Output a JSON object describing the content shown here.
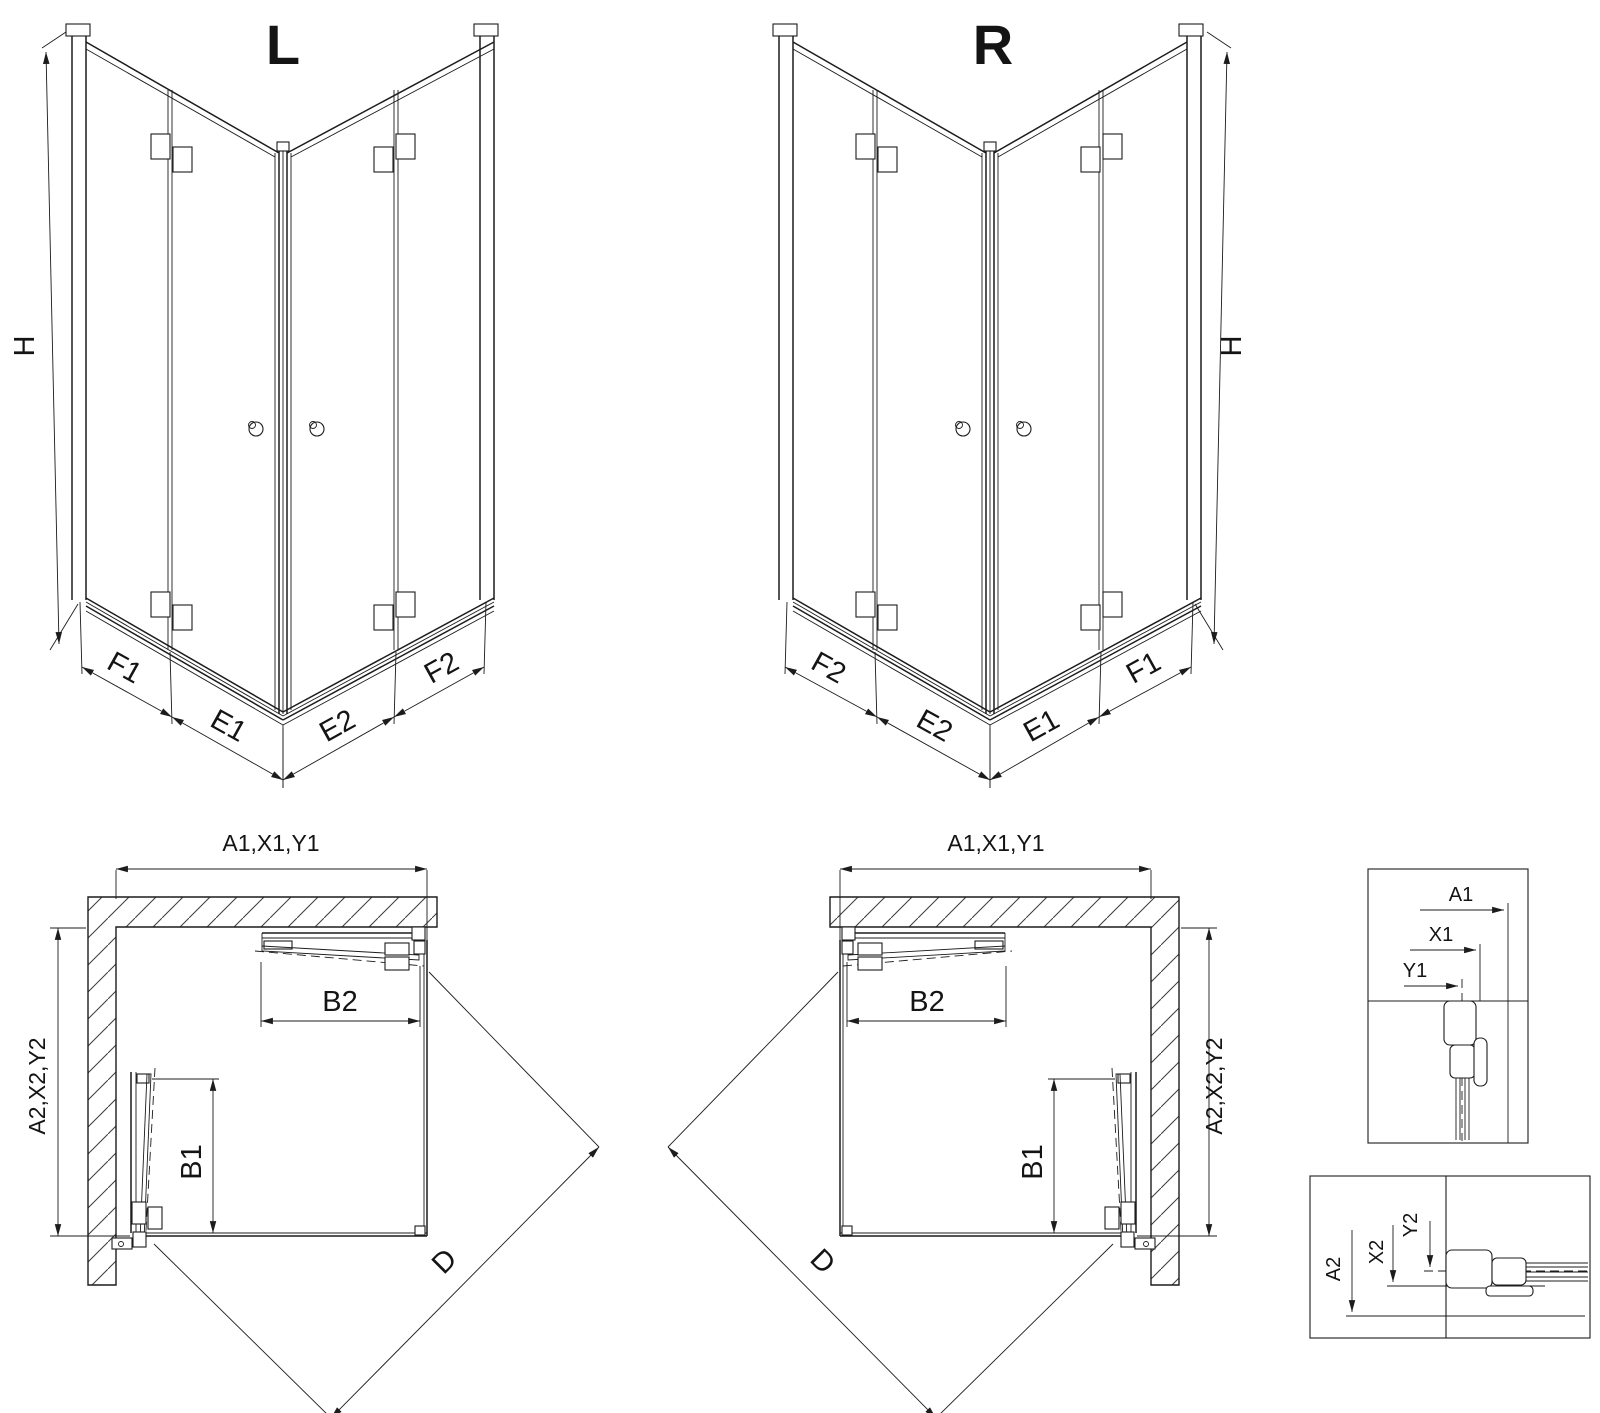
{
  "diagram": {
    "left_3d": {
      "title": "L",
      "h": "H",
      "f1": "F1",
      "e1": "E1",
      "e2": "E2",
      "f2": "F2"
    },
    "right_3d": {
      "title": "R",
      "h": "H",
      "f2": "F2",
      "e2": "E2",
      "e1": "E1",
      "f1": "F1"
    },
    "left_plan": {
      "top": "A1,X1,Y1",
      "side": "A2,X2,Y2",
      "b2": "B2",
      "b1": "B1",
      "d": "D"
    },
    "right_plan": {
      "top": "A1,X1,Y1",
      "side": "A2,X2,Y2",
      "b2": "B2",
      "b1": "B1",
      "d": "D"
    },
    "detail_top": {
      "a1": "A1",
      "x1": "X1",
      "y1": "Y1"
    },
    "detail_bottom": {
      "a2": "A2",
      "x2": "X2",
      "y2": "Y2"
    }
  },
  "colors": {
    "line": "#1c1c1c",
    "background": "#ffffff"
  }
}
